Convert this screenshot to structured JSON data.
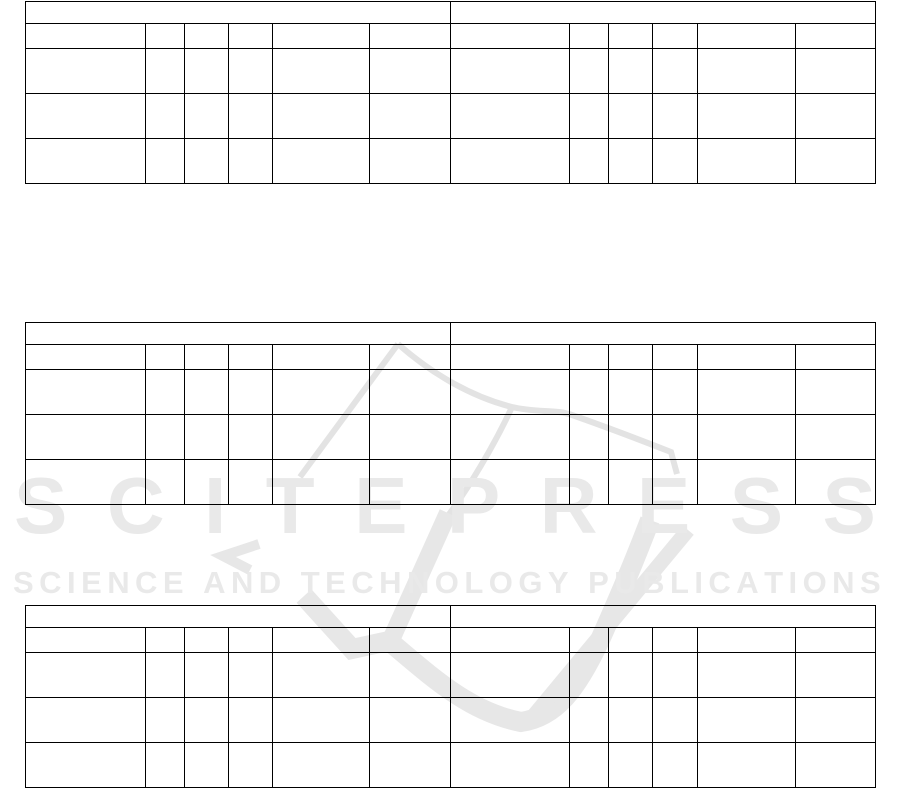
{
  "page": {
    "background_color": "#ffffff",
    "table_border_color": "#000000"
  },
  "watermark": {
    "brand": "SCITEPRESS",
    "tagline": "SCIENCE AND TECHNOLOGY PUBLICATIONS",
    "text_color": "#e9e9e9",
    "thin_stroke_color": "#e3e3e3",
    "thick_stroke_color": "#e7e7e7"
  },
  "table_structure": {
    "tables_count": 3,
    "halves_per_table": 2,
    "columns_per_half": 6,
    "caption_rows_per_half": 1,
    "header_rows_per_half": 1,
    "data_rows_per_half": 3,
    "all_cells_blank": true
  },
  "tables": [
    {
      "id": "table-1"
    },
    {
      "id": "table-2"
    },
    {
      "id": "table-3"
    }
  ]
}
